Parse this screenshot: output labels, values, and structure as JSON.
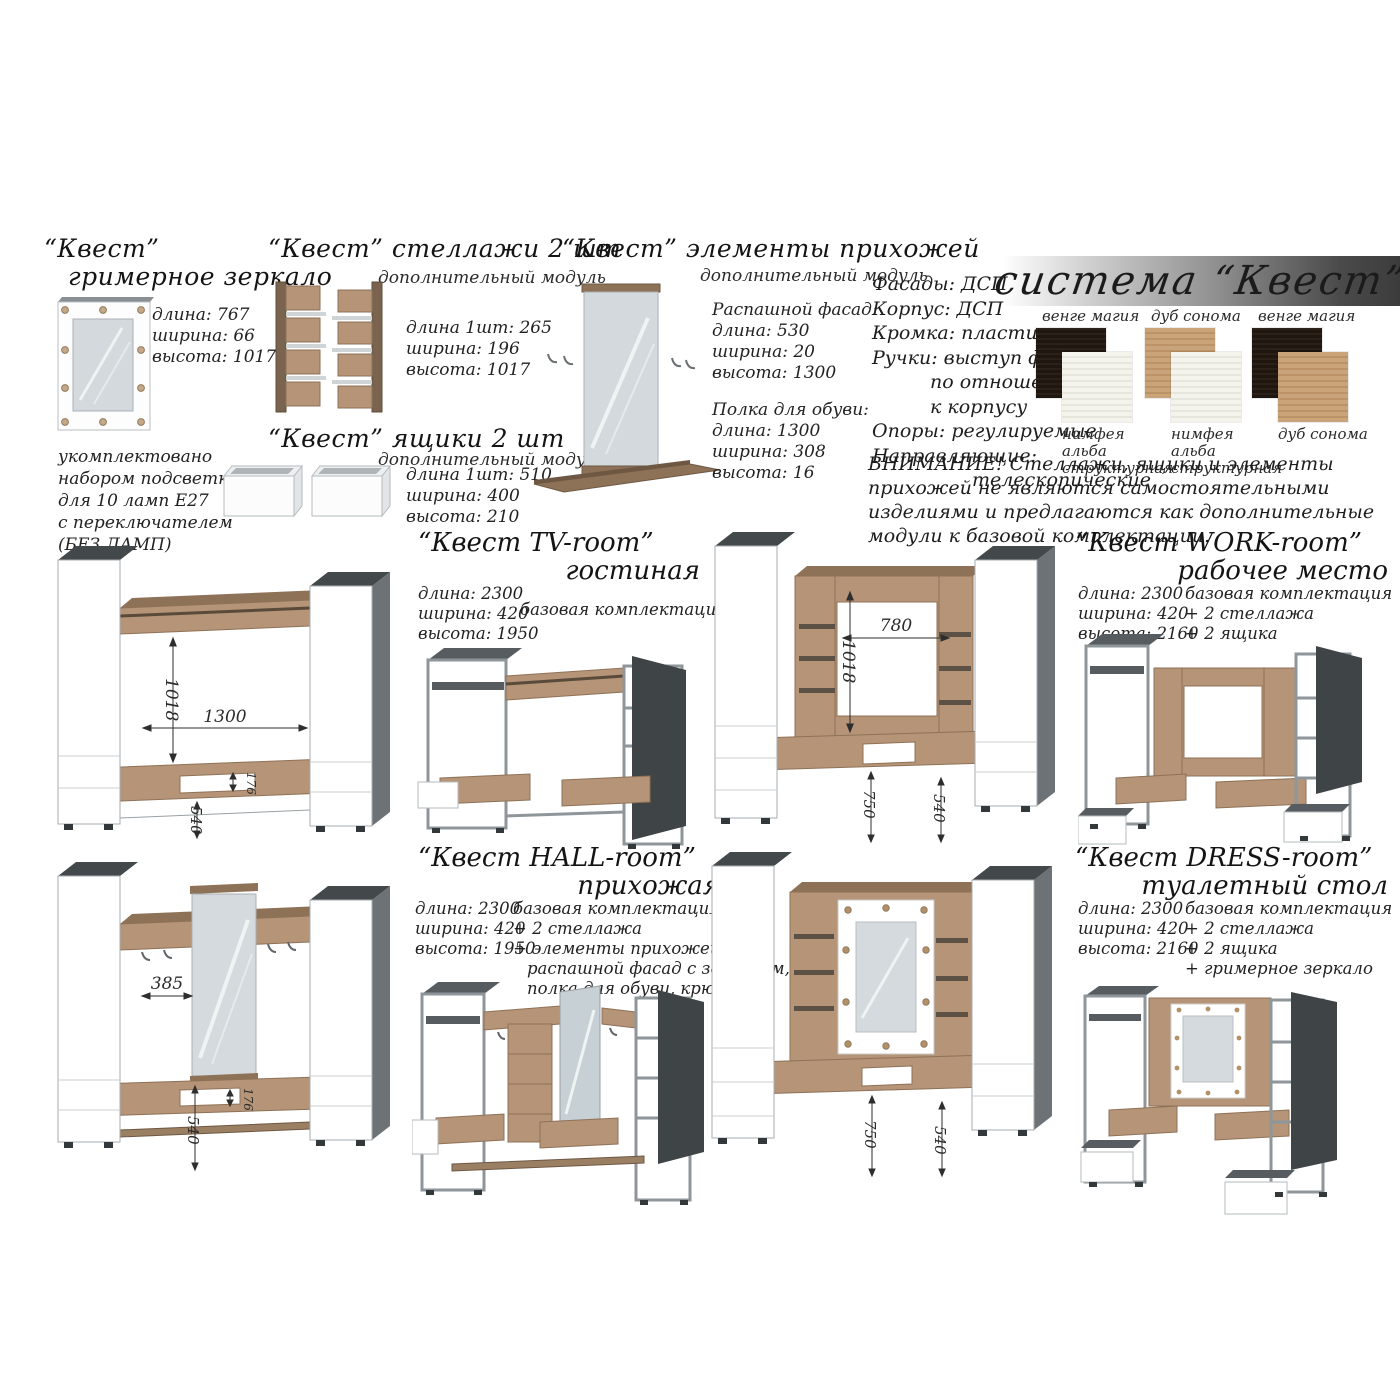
{
  "system": {
    "banner": "система “Квест”",
    "specs": [
      "Фасады: ДСП",
      "Корпус: ДСП",
      "Кромка: пластиковая",
      "Ручки: выступ фасада",
      "по отношению",
      "к корпусу",
      "Опоры: регулируемые",
      "Направляющие:",
      "телескопические"
    ],
    "warning": "ВНИМАНИЕ! Стеллажи, ящики и элементы прихожей не являются самостоятельными изделиями и предлагаются как дополнительные модули к базовой комплектации.",
    "colors": {
      "venge_magia": "#251b14",
      "dub_sonoma": "#c6a078",
      "nimfea_alba": "#f1f0e8"
    },
    "swatches": [
      {
        "top_label": "венге магия",
        "bottom_label": "нимфея альба структурная"
      },
      {
        "top_label": "дуб сонома",
        "bottom_label": "нимфея альба структурная"
      },
      {
        "top_label": "венге магия",
        "bottom_label": "дуб сонома"
      }
    ]
  },
  "modules": {
    "mirror": {
      "title1": "“Квест”",
      "title2": "гримерное зеркало",
      "dims": [
        "длина:  767",
        "ширина: 66",
        "высота: 1017"
      ],
      "note": [
        "укомплектовано",
        "набором подсветки",
        "для 10 ламп Е27",
        "с переключателем",
        "(БЕЗ ЛАМП)"
      ]
    },
    "shelves": {
      "title": "“Квест” стеллажи 2 шт",
      "subtitle": "дополнительный модуль",
      "dims": [
        "длина 1шт: 265",
        "ширина: 196",
        "высота: 1017"
      ]
    },
    "drawers": {
      "title": "“Квест” ящики 2 шт",
      "subtitle": "дополнительный модуль",
      "dims": [
        "длина 1шт:  510",
        "ширина: 400",
        "высота: 210"
      ]
    },
    "hallway": {
      "title": "“Квест” элементы прихожей",
      "subtitle": "дополнительный модуль",
      "facade_title": "Распашной фасад:",
      "facade_dims": [
        "длина: 530",
        "ширина: 20",
        "высота: 1300"
      ],
      "shoe_title": "Полка для обуви:",
      "shoe_dims": [
        "длина: 1300",
        "ширина: 308",
        "высота: 16"
      ]
    }
  },
  "rooms": {
    "tv": {
      "title": "“Квест TV-room”",
      "subtitle": "гостиная",
      "dims": [
        "длина:  2300",
        "ширина: 420",
        "высота: 1950"
      ],
      "config": [
        "базовая комплектация"
      ],
      "dd": [
        "1018",
        "1300",
        "176",
        "540"
      ]
    },
    "work": {
      "title": "“Квест WORK-room”",
      "subtitle": "рабочее место",
      "dims": [
        "длина: 2300",
        "ширина: 420",
        "высота: 2160"
      ],
      "config": [
        "базовая комплектация",
        "+ 2 стеллажа",
        "+ 2 ящика"
      ],
      "dd": [
        "780",
        "1018",
        "750",
        "540"
      ]
    },
    "hall": {
      "title": "“Квест HALL-room”",
      "subtitle": "прихожая",
      "dims": [
        "длина: 2300",
        "ширина: 420",
        "высота: 1950"
      ],
      "config": [
        "базовая комплектация",
        "+ 2 стеллажа",
        "+ элементы прихожей:",
        "распашной фасад с зеркалом,",
        "полка для обуви, крючки"
      ],
      "dd": [
        "385",
        "176",
        "540"
      ]
    },
    "dress": {
      "title": "“Квест DRESS-room”",
      "subtitle": "туалетный стол",
      "dims": [
        "длина: 2300",
        "ширина: 420",
        "высота: 2160"
      ],
      "config": [
        "базовая комплектация",
        "+ 2 стеллажа",
        "+ 2 ящика",
        "+ гримерное зеркало"
      ],
      "dd": [
        "750",
        "540"
      ]
    }
  }
}
